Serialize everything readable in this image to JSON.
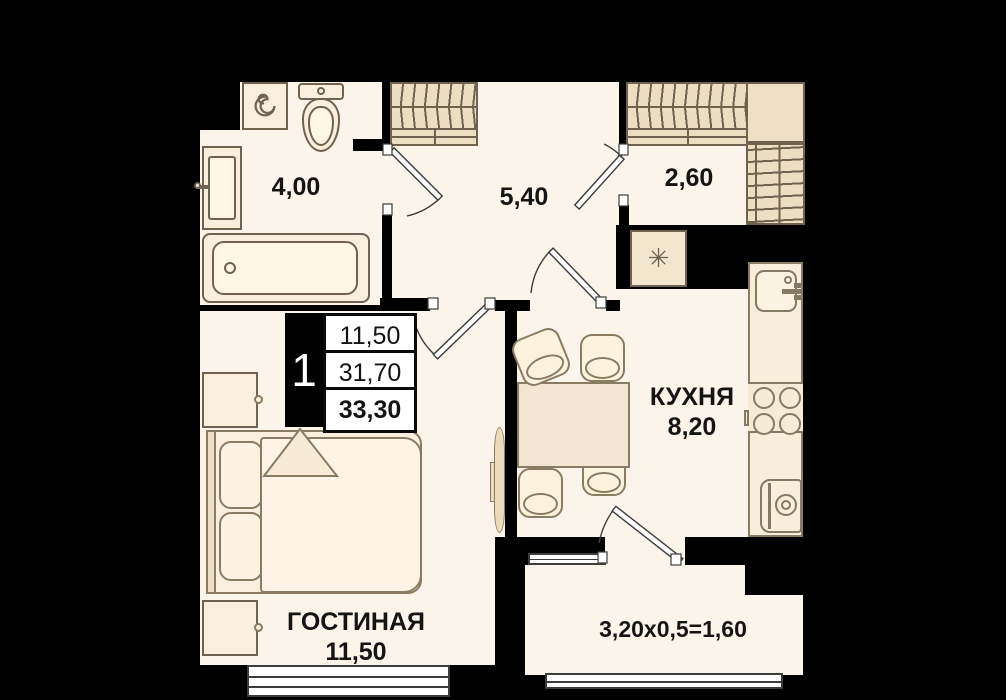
{
  "unit_card": {
    "rooms_count": "1",
    "row1": "11,50",
    "row2": "31,70",
    "row3": "33,30"
  },
  "rooms": {
    "bathroom": {
      "area": "4,00"
    },
    "hallway": {
      "area": "5,40"
    },
    "wardrobe": {
      "area": "2,60"
    },
    "kitchen": {
      "name": "КУХНЯ",
      "area": "8,20"
    },
    "living": {
      "name": "ГОСТИНАЯ",
      "area": "11,50"
    },
    "balcony": {
      "dimensions": "3,20х0,5=1,60"
    }
  },
  "icons": {
    "shaft": "✳"
  },
  "colors": {
    "background": "#000000",
    "floor": "#faf4ea",
    "furniture": "#f9efdc",
    "wardrobe_fill": "#ecdec0",
    "outline": "#6f6350",
    "text": "#141414"
  }
}
